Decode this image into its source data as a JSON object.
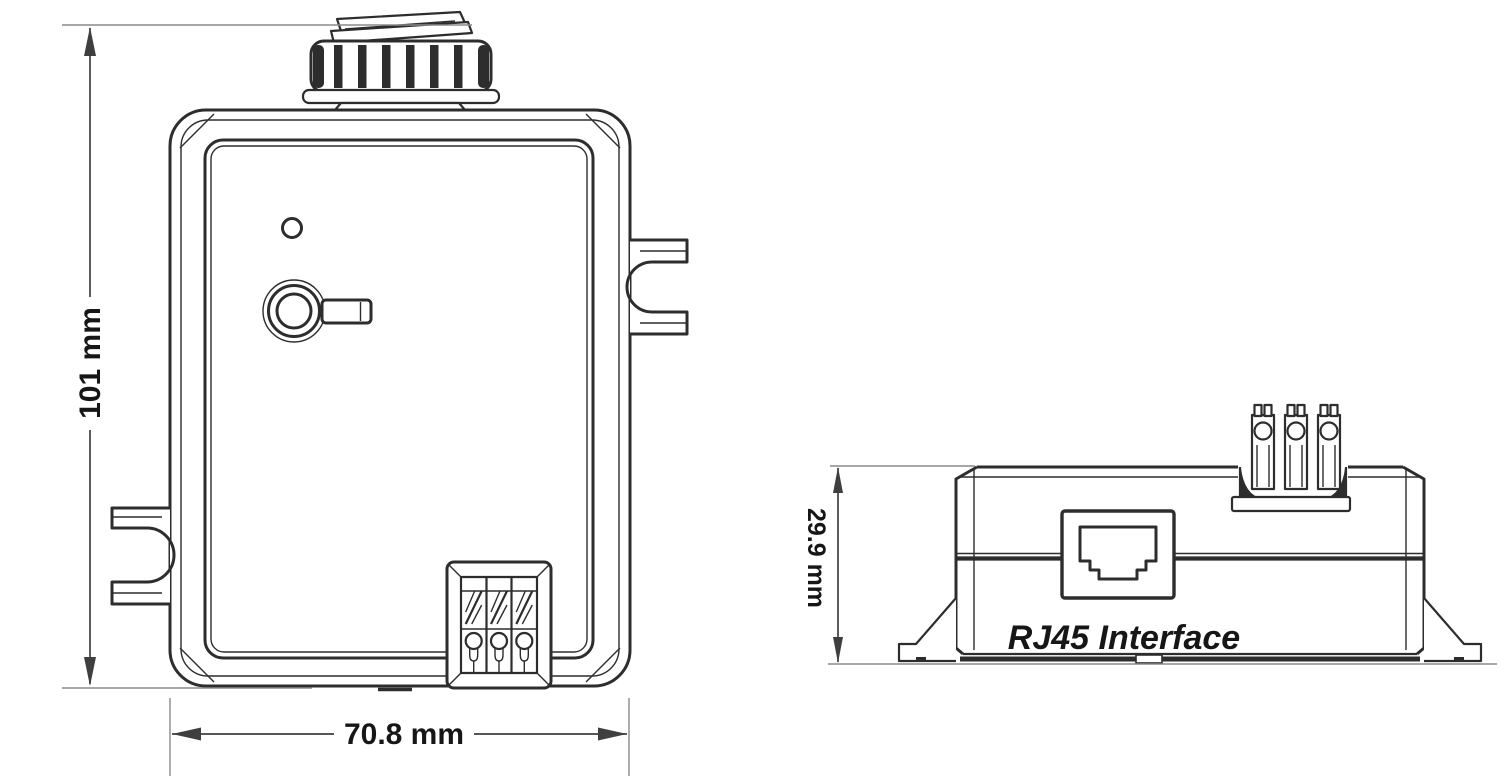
{
  "diagram": {
    "type": "technical-dimension-drawing",
    "views": {
      "front_view": {
        "name": "front view of device with rotary switch, LED, terminal block and mounting tabs",
        "height_dimension": "101 mm",
        "width_dimension": "70.8 mm"
      },
      "side_view": {
        "name": "bottom/side view of device with RJ45 port and terminal block",
        "height_dimension": "29.9 mm",
        "port_label": "RJ45 Interface"
      }
    },
    "colors": {
      "background": "#ffffff",
      "line": "#2d2d2d",
      "dimension": "#3f3f3f",
      "extension": "#8a8a8a",
      "text": "#161616"
    }
  }
}
